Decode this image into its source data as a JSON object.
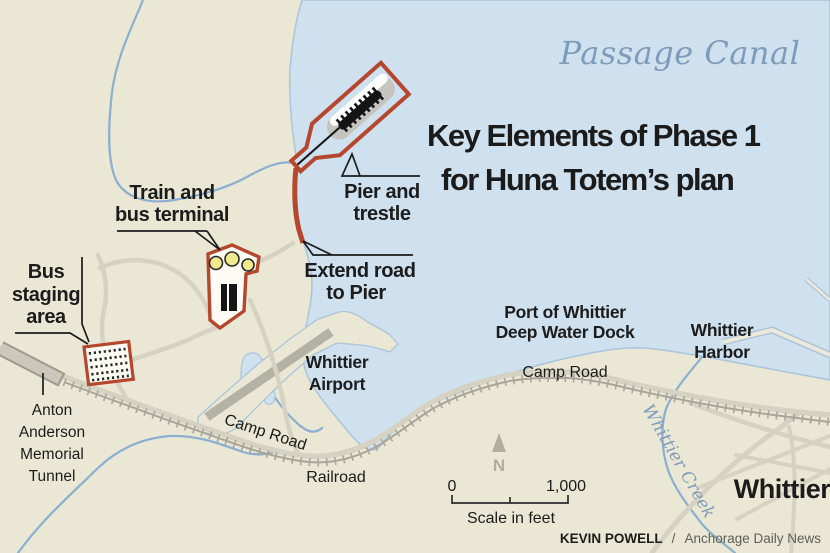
{
  "map": {
    "title": {
      "line1": "Key Elements of Phase 1",
      "line2": "for Huna Totem’s plan"
    },
    "water_name": "Passage Canal",
    "labels": {
      "bus_staging": [
        "Bus",
        "staging",
        "area"
      ],
      "train_terminal": [
        "Train and",
        "bus terminal"
      ],
      "pier_trestle": [
        "Pier and",
        "trestle"
      ],
      "extend_road": [
        "Extend road",
        "to Pier"
      ],
      "whittier_airport": [
        "Whittier",
        "Airport"
      ],
      "port_dock": [
        "Port of Whittier",
        "Deep Water Dock"
      ],
      "whittier_harbor": [
        "Whittier",
        "Harbor"
      ],
      "camp_road_west": "Camp Road",
      "camp_road_east": "Camp Road",
      "railroad": "Railroad",
      "whittier_creek": "Whittier Creek",
      "whittier_town": "Whittier",
      "tunnel": [
        "Anton",
        "Anderson",
        "Memorial",
        "Tunnel"
      ]
    },
    "scale": {
      "start": "0",
      "end": "1,000",
      "caption": "Scale in feet"
    },
    "compass": {
      "north": "N"
    },
    "credit": {
      "author": "KEVIN POWELL",
      "separator": "/",
      "source": "Anchorage Daily News"
    },
    "colors": {
      "land": "#eae7d5",
      "water": "#cfe0ee",
      "plan_red": "#b5472e",
      "road": "#d6d2c2",
      "railroad": "#a9a599",
      "creek": "#8aafd0",
      "water_text": "#7d9cba",
      "ink": "#1c1c1c",
      "credit_gray": "#5f5e57",
      "compass_gray": "#b2ae9f"
    }
  }
}
